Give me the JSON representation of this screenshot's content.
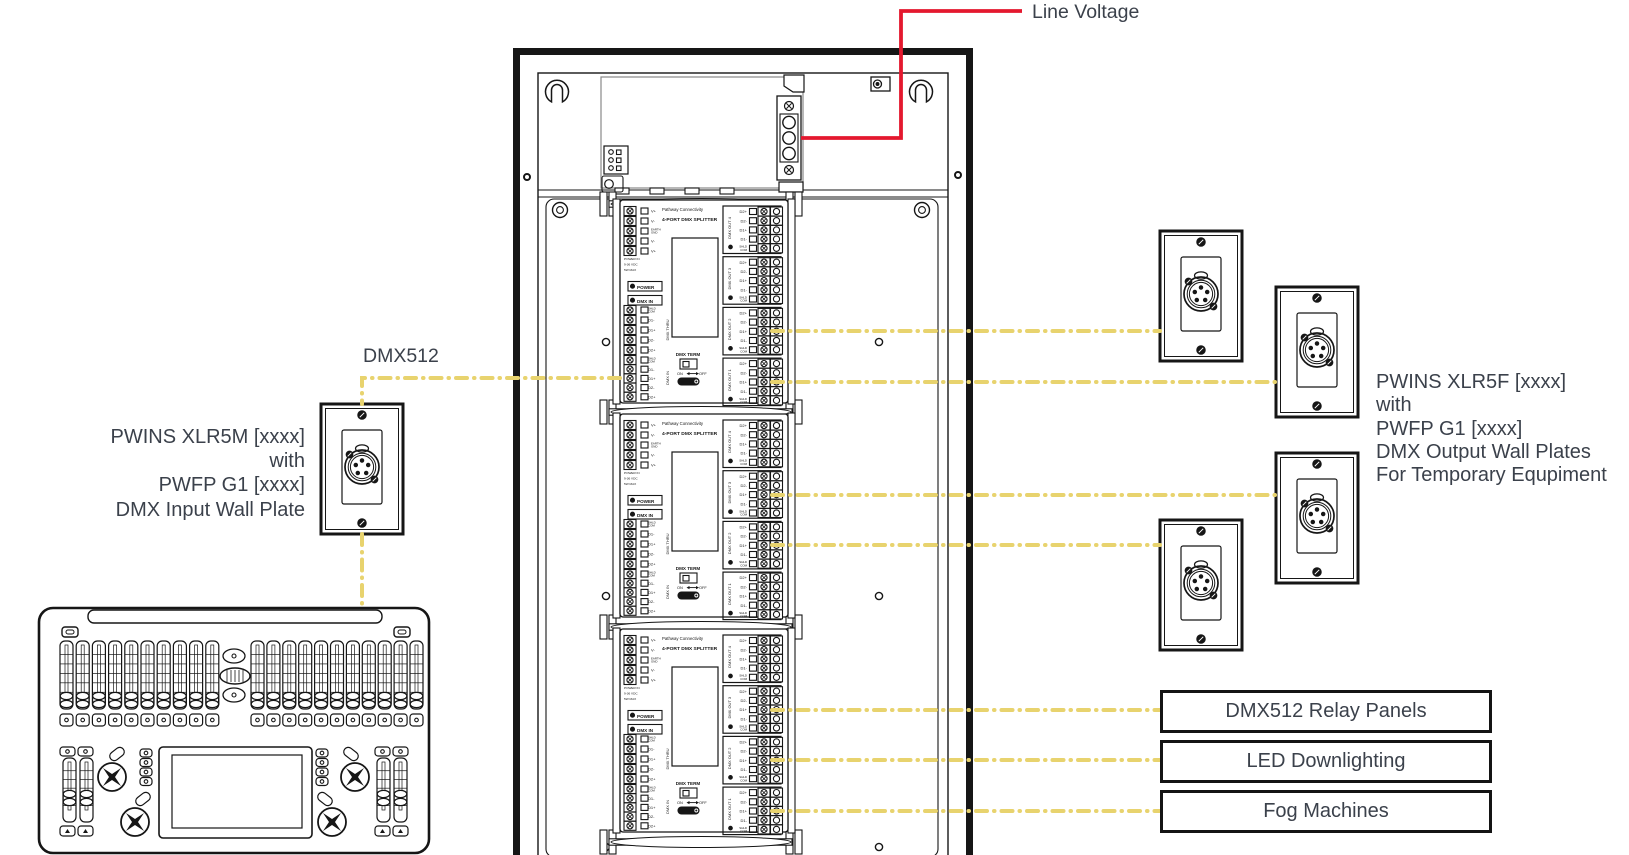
{
  "labels": {
    "line_voltage": "Line Voltage",
    "dmx512": "DMX512"
  },
  "wall_plates": {
    "input": {
      "caption_lines": [
        "PWINS XLR5M [xxxx]",
        "with",
        "PWFP G1 [xxxx]",
        "DMX Input Wall Plate"
      ]
    },
    "output": {
      "caption_lines": [
        "PWINS XLR5F [xxxx]",
        "with",
        "PWFP G1 [xxxx]",
        "DMX Output Wall Plates",
        "For Temporary Equpiment"
      ]
    }
  },
  "equipment_boxes": [
    "DMX512 Relay Panels",
    "LED Downlighting",
    "Fog Machines"
  ],
  "splitter_module": {
    "brand": "Pathway Connectivity",
    "model": "4-PORT DMX SPLITTER",
    "power_terminals": [
      "V+",
      "V-",
      "EARTH GND",
      "V-",
      "V+"
    ],
    "power_note": [
      "POWER IN",
      "9-36 VDC",
      "5W MAX"
    ],
    "led_labels": [
      "POWER",
      "DMX IN"
    ],
    "thru_label": "DMX THRU",
    "in_label": "DMX IN",
    "data_terminals": [
      "SHLD COM",
      "D1-",
      "D1+",
      "D2-",
      "D2+"
    ],
    "out_terminals": [
      "D2+",
      "D2-",
      "D1+",
      "D1-",
      "SHLD COM"
    ],
    "outputs": [
      "DMX OUT 4",
      "DMX OUT 3",
      "DMX OUT 2",
      "DMX OUT 1"
    ],
    "term_label": "DMX TERM",
    "term_on": "ON",
    "term_off": "OFF",
    "iso_label": "ISO 5V"
  },
  "colors": {
    "dmx_wire": "#e8d36e",
    "line_voltage_wire": "#e4182e",
    "label_text": "#3b414b",
    "line_art": "#161616",
    "psu_outline": "#888888"
  }
}
